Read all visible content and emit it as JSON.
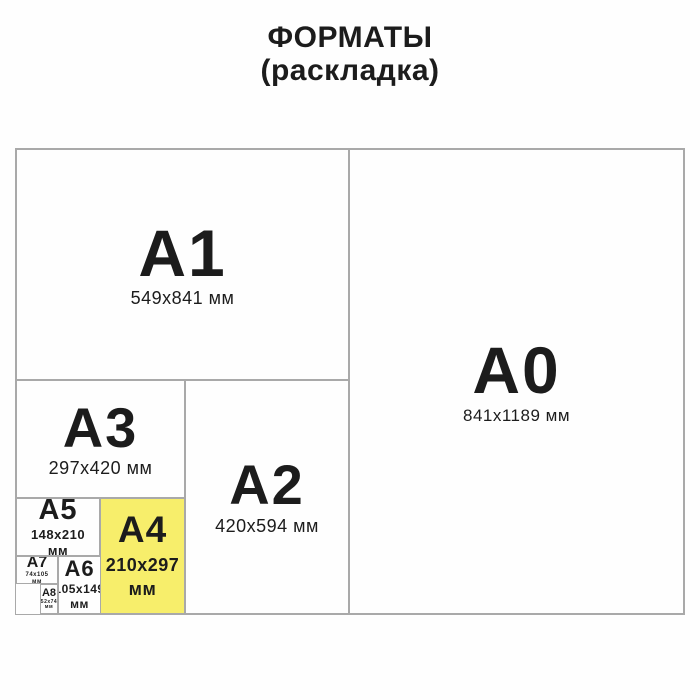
{
  "title": {
    "line1": "ФОРМАТЫ",
    "line2": "(раскладка)"
  },
  "colors": {
    "highlight": "#f7ee6b",
    "line": "#a9a9a9",
    "text": "#1c1c1c"
  },
  "formats": [
    {
      "code": "A1",
      "size_lines": [
        "549x841 мм"
      ]
    },
    {
      "code": "A0",
      "size_lines": [
        "841x1189 мм"
      ]
    },
    {
      "code": "A3",
      "size_lines": [
        "297x420 мм"
      ]
    },
    {
      "code": "A2",
      "size_lines": [
        "420x594 мм"
      ]
    },
    {
      "code": "A5",
      "size_lines": [
        "148x210",
        "мм"
      ]
    },
    {
      "code": "A4",
      "size_lines": [
        "210x297",
        "мм"
      ],
      "highlighted": true
    },
    {
      "code": "A7",
      "size_lines": [
        "74x105",
        "мм"
      ]
    },
    {
      "code": "A6",
      "size_lines": [
        "105x149",
        "мм"
      ]
    },
    {
      "code": "A8",
      "size_lines": [
        "52x74",
        "мм"
      ]
    }
  ]
}
